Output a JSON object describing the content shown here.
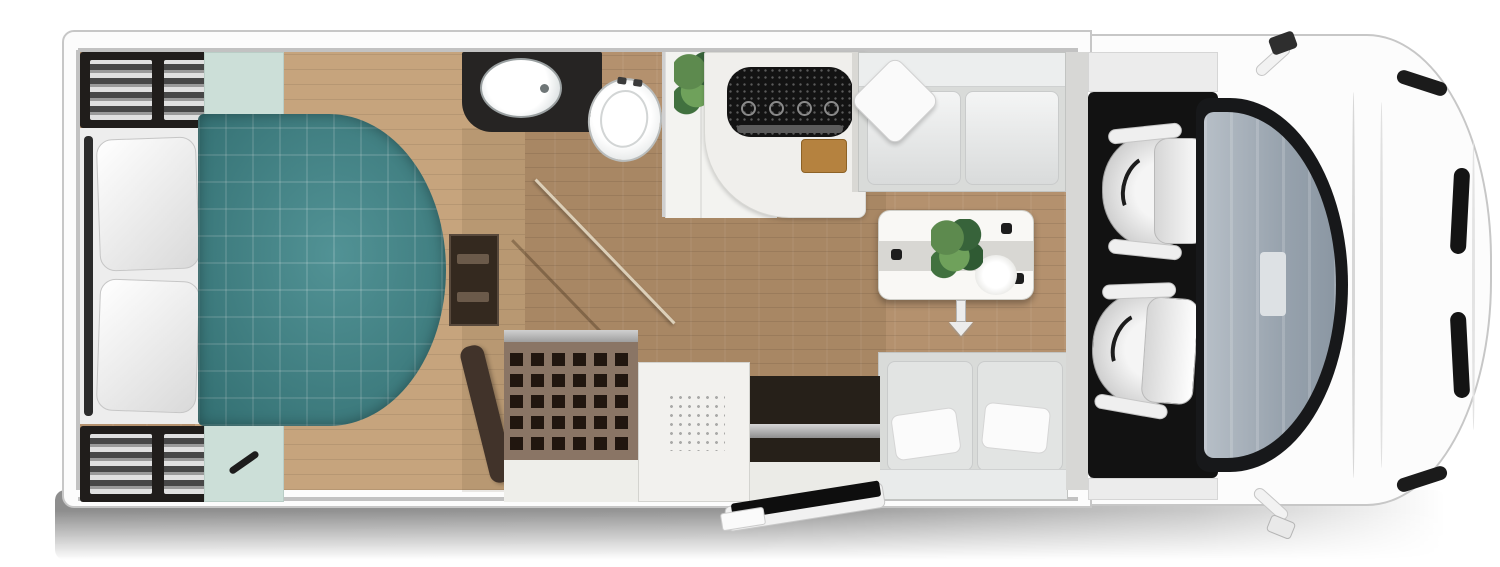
{
  "scene": {
    "type": "motorhome-floorplan-top-view",
    "orientation": "cab-on-right-rear-on-left",
    "visible_text": []
  },
  "palette": {
    "body_white": "#fcfcfc",
    "outline_gray": "#c7c7c7",
    "wall_gray": "#c2c2c2",
    "wood_mid": "#b4916e",
    "wood_light": "#c6a47d",
    "bed_teal": "#3e8689",
    "mint": "#ccdfd8",
    "dark_cabinet": "#201d1b",
    "counter_dark": "#262423",
    "kitchen_white": "#f0efec",
    "cooktop_black": "#131313",
    "board_wood": "#b5823f",
    "bench_gray": "#d9dbd9",
    "table_white": "#f9f8f5",
    "runner_gray": "#d8d7d3",
    "door_brown": "#41332a",
    "grille_taupe": "#8a7565",
    "grille_hole": "#21160f",
    "recess_dark": "#262019",
    "step_black": "#0e0e0e",
    "cab_black": "#121212",
    "shadow_gray": "#8e8e8e"
  },
  "furniture": {
    "bedroom": [
      "island-bed-teal-quilt",
      "headboard",
      "pillow-left",
      "pillow-right",
      "wardrobe-rear-top",
      "wardrobe-rear-bottom",
      "mint-side-panel-top",
      "mint-side-panel-bottom",
      "foot-of-bed-cabinet",
      "bedroom-steps"
    ],
    "bathroom": [
      "washbasin-on-dark-counter",
      "toilet",
      "shower-room-door",
      "potted-plant"
    ],
    "kitchen": [
      "kitchen-counter",
      "combi-cooktop-sink",
      "cutting-board"
    ],
    "dinette": [
      "bench-seat-front",
      "bench-seat-rear",
      "dining-table",
      "table-plant",
      "table-runner",
      "cups",
      "plates",
      "table-pedestal"
    ],
    "entry": [
      "open-interior-door",
      "grille-cabinet",
      "shower-tray",
      "entry-doorway",
      "exterior-electric-step"
    ],
    "cab": [
      "driver-swivel-seat",
      "passenger-swivel-seat",
      "cab-floor-mat",
      "windshield",
      "interior-rearview-mirror",
      "hood",
      "headlights",
      "grille-slots",
      "wing-mirror-left",
      "wing-mirror-right"
    ]
  }
}
